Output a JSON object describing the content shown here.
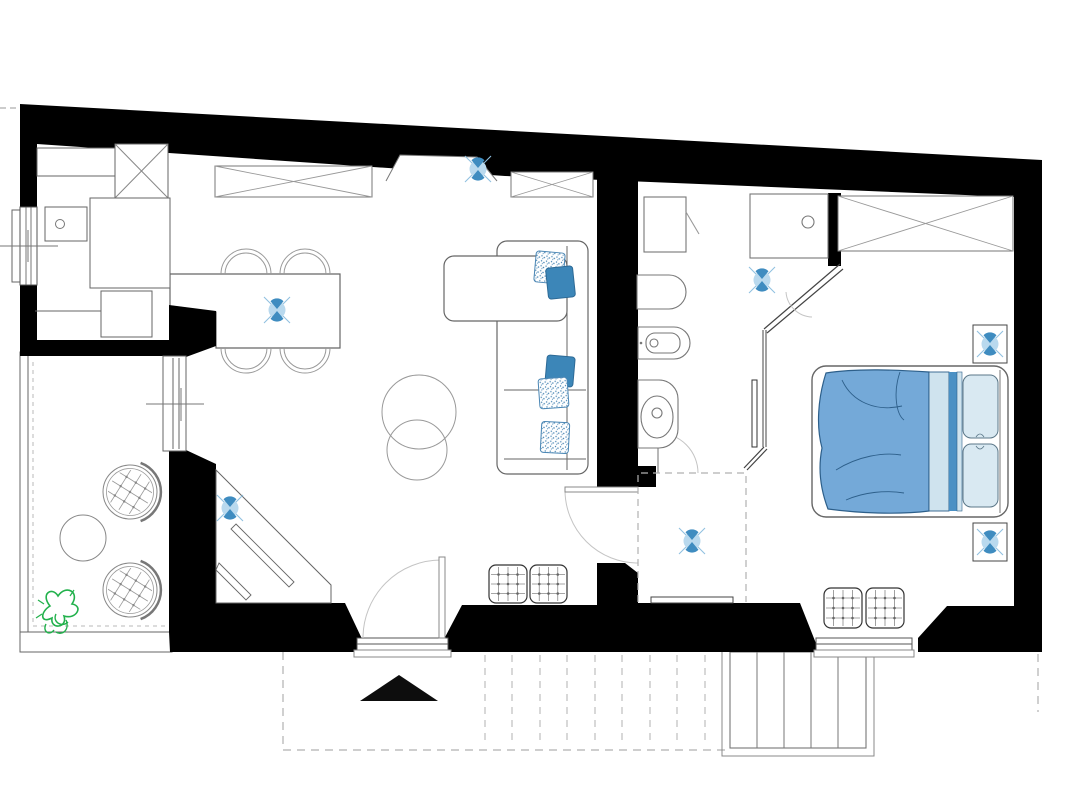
{
  "meta": {
    "type": "apartment-floor-plan",
    "width": 1079,
    "height": 798
  },
  "palette": {
    "wall": "#000000",
    "line": "#666666",
    "light_line": "#9a9a9a",
    "dash_gray": "#b0b0b0",
    "accent_blue": "#4191c6",
    "mid_blue": "#74a9d8",
    "pale_blue": "#cfe3ee",
    "pillow_blue": "#3c86b8",
    "plant_green": "#22b14c"
  },
  "rooms": [
    {
      "name": "kitchen"
    },
    {
      "name": "living-dining-room"
    },
    {
      "name": "terrace"
    },
    {
      "name": "bathroom"
    },
    {
      "name": "hallway"
    },
    {
      "name": "bedroom"
    },
    {
      "name": "entrance-deck"
    },
    {
      "name": "outdoor-stairs"
    }
  ],
  "ceiling_lights": [
    {
      "x": 478,
      "y": 169
    },
    {
      "x": 277,
      "y": 310
    },
    {
      "x": 230,
      "y": 508
    },
    {
      "x": 762,
      "y": 280
    },
    {
      "x": 692,
      "y": 541
    },
    {
      "x": 990,
      "y": 344
    },
    {
      "x": 990,
      "y": 542
    }
  ],
  "wall_light_boxes": [
    {
      "x": 973,
      "y": 325,
      "w": 34,
      "h": 38
    },
    {
      "x": 973,
      "y": 523,
      "w": 34,
      "h": 38
    }
  ],
  "grid_poufs": [
    {
      "x": 489,
      "y": 565,
      "w": 38,
      "h": 38
    },
    {
      "x": 530,
      "y": 565,
      "w": 37,
      "h": 38
    },
    {
      "x": 824,
      "y": 588,
      "w": 38,
      "h": 40
    },
    {
      "x": 866,
      "y": 588,
      "w": 38,
      "h": 40
    }
  ],
  "sofa_cushions": [
    {
      "x": 535,
      "y": 252,
      "w": 29,
      "h": 31,
      "angle": 5,
      "style": "stipple"
    },
    {
      "x": 547,
      "y": 267,
      "w": 27,
      "h": 31,
      "angle": -6,
      "style": "solid"
    },
    {
      "x": 546,
      "y": 356,
      "w": 28,
      "h": 30,
      "angle": 5,
      "style": "solid"
    },
    {
      "x": 539,
      "y": 378,
      "w": 29,
      "h": 30,
      "angle": -4,
      "style": "stipple"
    },
    {
      "x": 541,
      "y": 422,
      "w": 28,
      "h": 31,
      "angle": 3,
      "style": "stipple"
    }
  ],
  "dining_chairs": [
    {
      "cx": 246,
      "cy": 274,
      "side": "top"
    },
    {
      "cx": 305,
      "cy": 274,
      "side": "top"
    },
    {
      "cx": 246,
      "cy": 348,
      "side": "bottom"
    },
    {
      "cx": 305,
      "cy": 348,
      "side": "bottom"
    }
  ],
  "wicker_chairs": [
    {
      "cx": 130,
      "cy": 492
    },
    {
      "cx": 130,
      "cy": 590
    }
  ],
  "deck_boards_x": [
    485,
    512,
    540,
    567,
    595,
    622,
    650,
    677,
    705
  ],
  "deck_board_y": {
    "top": 655,
    "bottom": 746
  },
  "stair_treads_x": [
    757,
    784,
    811,
    838
  ],
  "stairs_box": {
    "x": 730,
    "y": 652,
    "w": 136,
    "h": 96
  }
}
